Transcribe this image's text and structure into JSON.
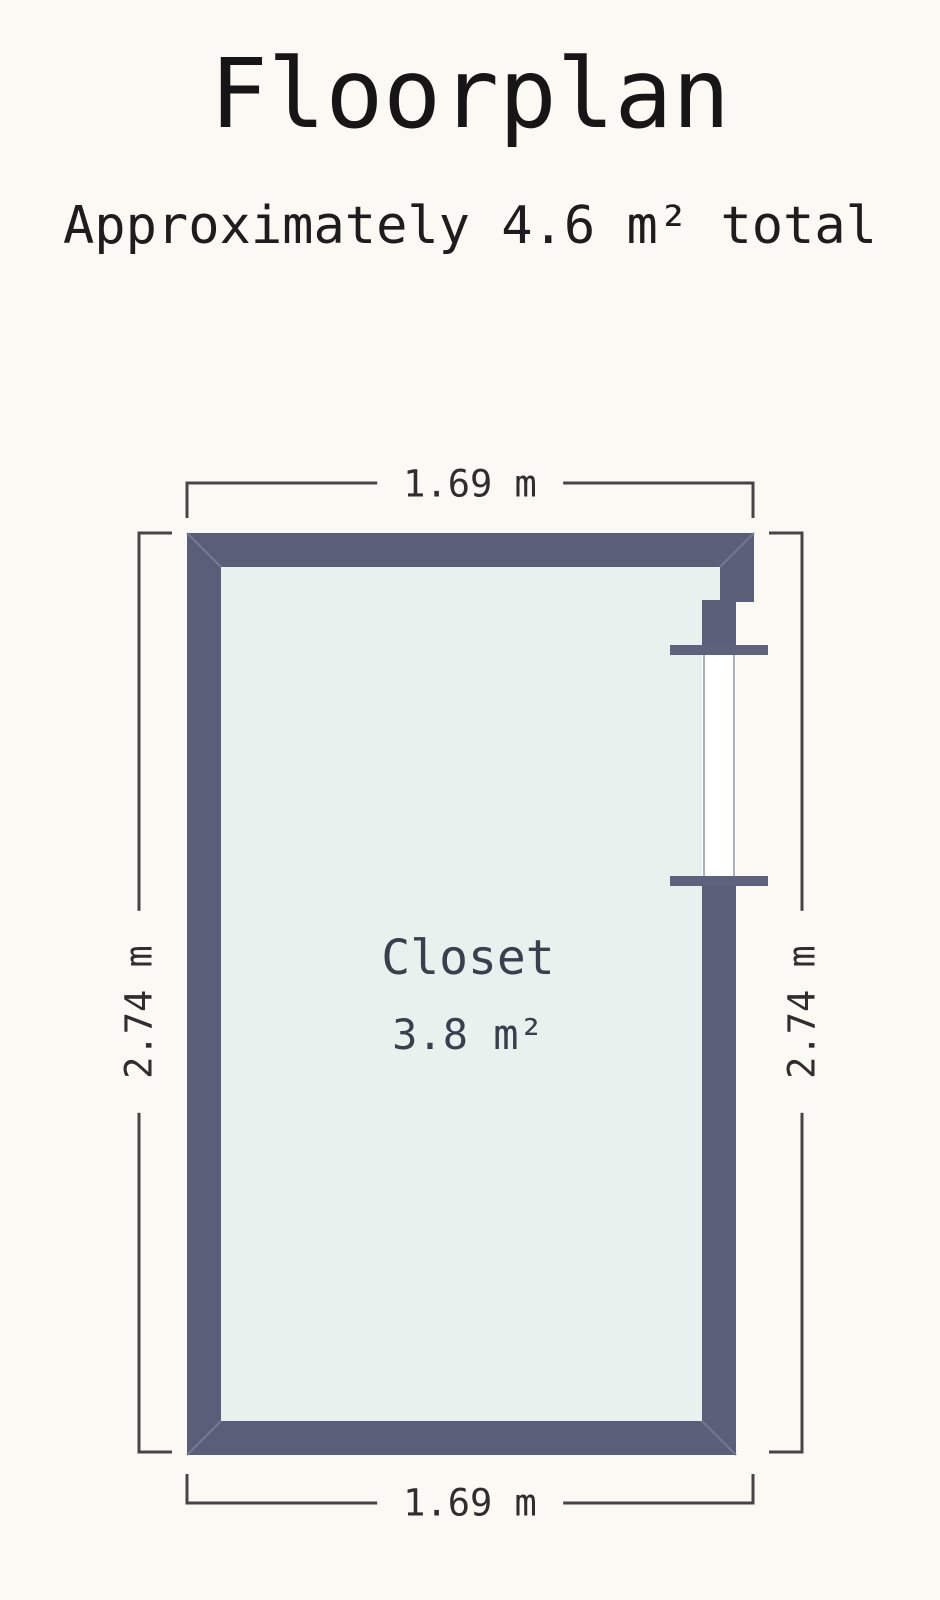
{
  "title": "Floorplan",
  "subtitle": "Approximately 4.6 m² total",
  "floorplan": {
    "room": {
      "name": "Closet",
      "area": "3.8 m²"
    },
    "dimensions": {
      "top": "1.69 m",
      "bottom": "1.69 m",
      "left": "2.74 m",
      "right": "2.74 m"
    },
    "colors": {
      "background": "#fbf9f4",
      "wall": "#5b5e78",
      "interior": "#e8f1ee",
      "miter": "#757891",
      "door_opening": "#ffffff",
      "door_jamb": "#aab0bc",
      "door_lintel": "#5f627c",
      "dim_line": "#454545",
      "dim_text": "#2e2e2e",
      "room_text": "#39404d"
    }
  }
}
